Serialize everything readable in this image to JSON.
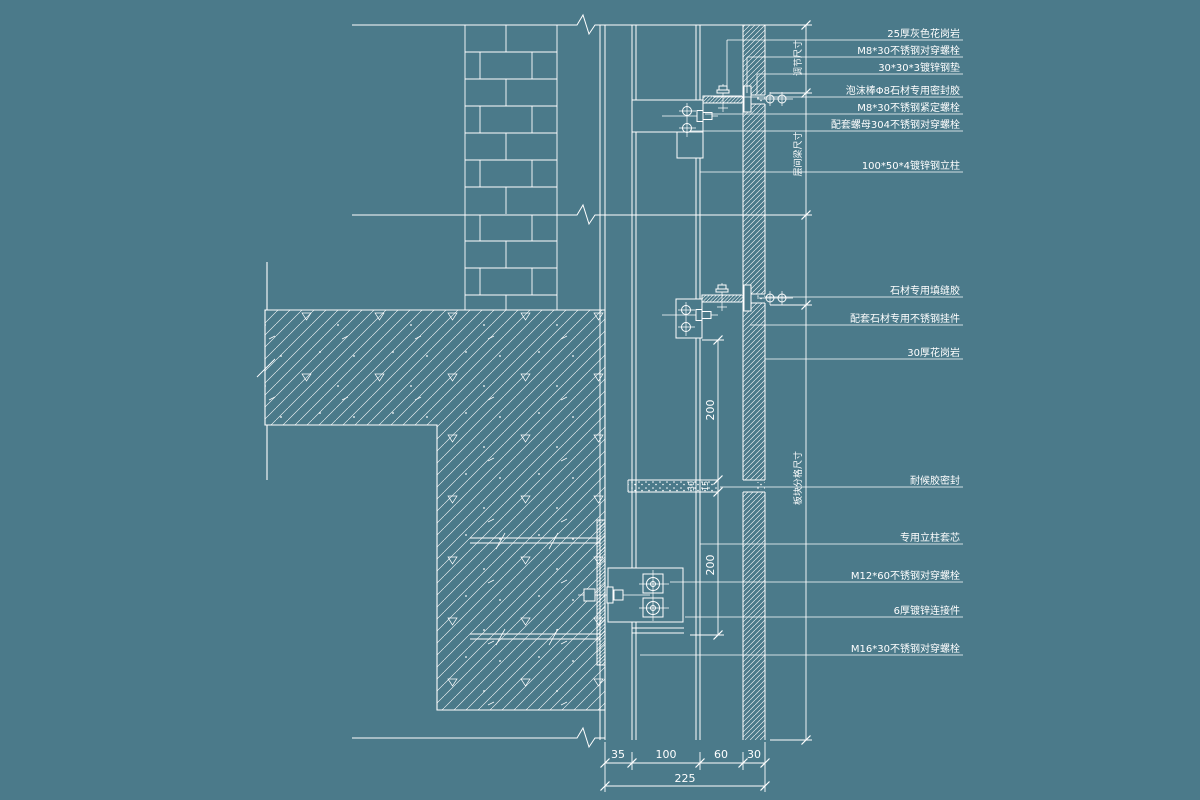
{
  "colors": {
    "background": "#4b7a8a",
    "line": "#ffffff",
    "text": "#ffffff"
  },
  "callouts": {
    "c1": "25厚灰色花岗岩",
    "c2": "M8*30不锈钢对穿螺栓",
    "c3": "30*30*3镀锌钢垫",
    "c4": "泡沫棒Φ8石材专用密封胶",
    "c5": "M8*30不锈钢紧定螺栓",
    "c6": "配套螺母304不锈钢对穿螺栓",
    "c7": "100*50*4镀锌钢立柱",
    "c8": "石材专用填缝胶",
    "c9": "配套石材专用不锈钢挂件",
    "c10": "30厚花岗岩",
    "c11": "耐候胶密封",
    "c12": "专用立柱套芯",
    "c13": "M12*60不锈钢对穿螺栓",
    "c14": "6厚镀锌连接件",
    "c15": "M16*30不锈钢对穿螺栓"
  },
  "dims": {
    "bottom_35": "35",
    "bottom_100": "100",
    "bottom_60": "60",
    "bottom_30": "30",
    "bottom_total": "225",
    "mid_200_upper": "200",
    "mid_200_lower": "200",
    "joint_30": "30",
    "joint_15": "15",
    "right_seg1": "调节尺寸",
    "right_seg2": "层间梁尺寸",
    "right_seg3": "板块分格尺寸"
  }
}
